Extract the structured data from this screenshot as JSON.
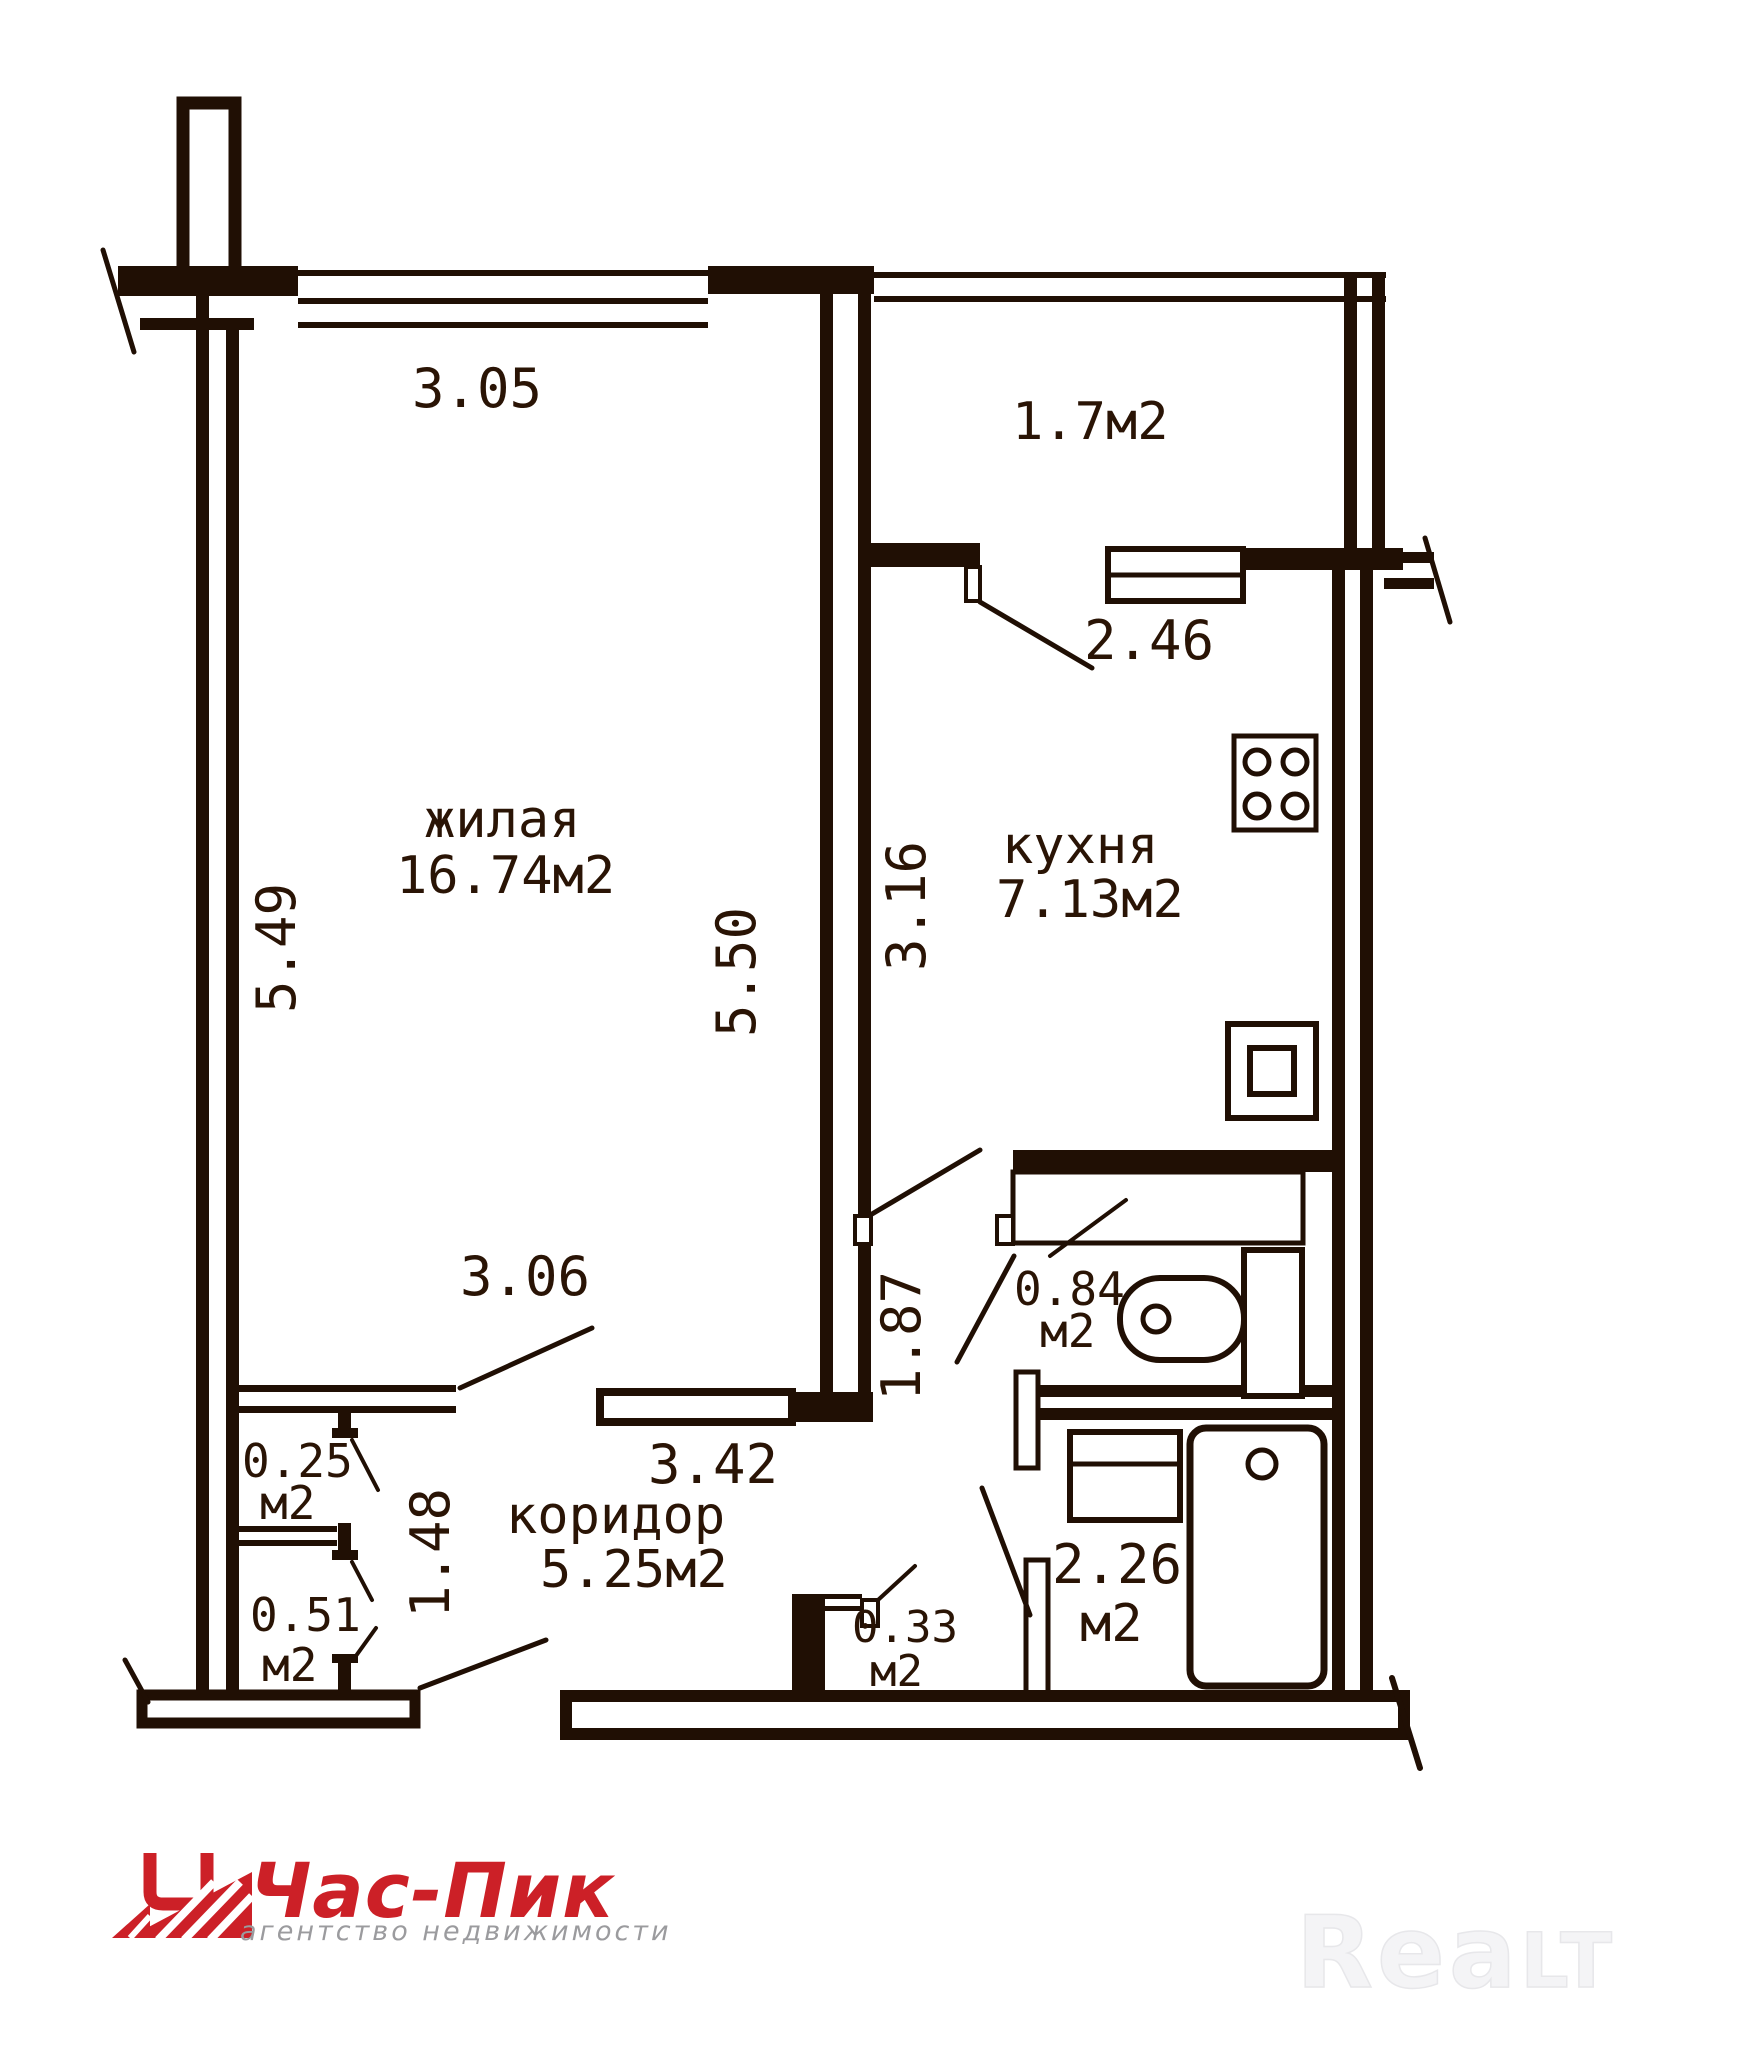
{
  "colors": {
    "ink": "#200f04",
    "background": "#ffffff",
    "logo_red": "#cc2027",
    "tagline_gray": "#9b9b9e",
    "watermark_gray": "#f4f4f6"
  },
  "plan": {
    "rooms": {
      "living": {
        "label": "жилая",
        "area": "16.74м2"
      },
      "kitchen": {
        "label": "кухня",
        "area": "7.13м2"
      },
      "corridor": {
        "label": "коридор",
        "area": "5.25м2"
      },
      "balcony": {
        "area": "1.7м2"
      },
      "toilet": {
        "area": "0.84",
        "unit": "м2"
      },
      "bathroom": {
        "area": "2.26",
        "unit": "м2"
      },
      "closet_top": {
        "area": "0.25",
        "unit": "м2"
      },
      "closet_bottom": {
        "area": "0.51",
        "unit": "м2"
      },
      "niche": {
        "area": "0.33",
        "unit": "м2"
      }
    },
    "dimensions": {
      "window_width": "3.05",
      "balcony_opening": "2.46",
      "living_depth_left": "5.49",
      "living_depth_right": "5.50",
      "kitchen_depth": "3.16",
      "living_width_bottom": "3.06",
      "hall_depth": "1.87",
      "closet_depth": "1.48",
      "corridor_width": "3.42"
    }
  },
  "branding": {
    "agency_name": "Час-Пик",
    "agency_tagline": "агентство недвижимости",
    "watermark_part1": "Rea",
    "watermark_part2": "LT"
  }
}
